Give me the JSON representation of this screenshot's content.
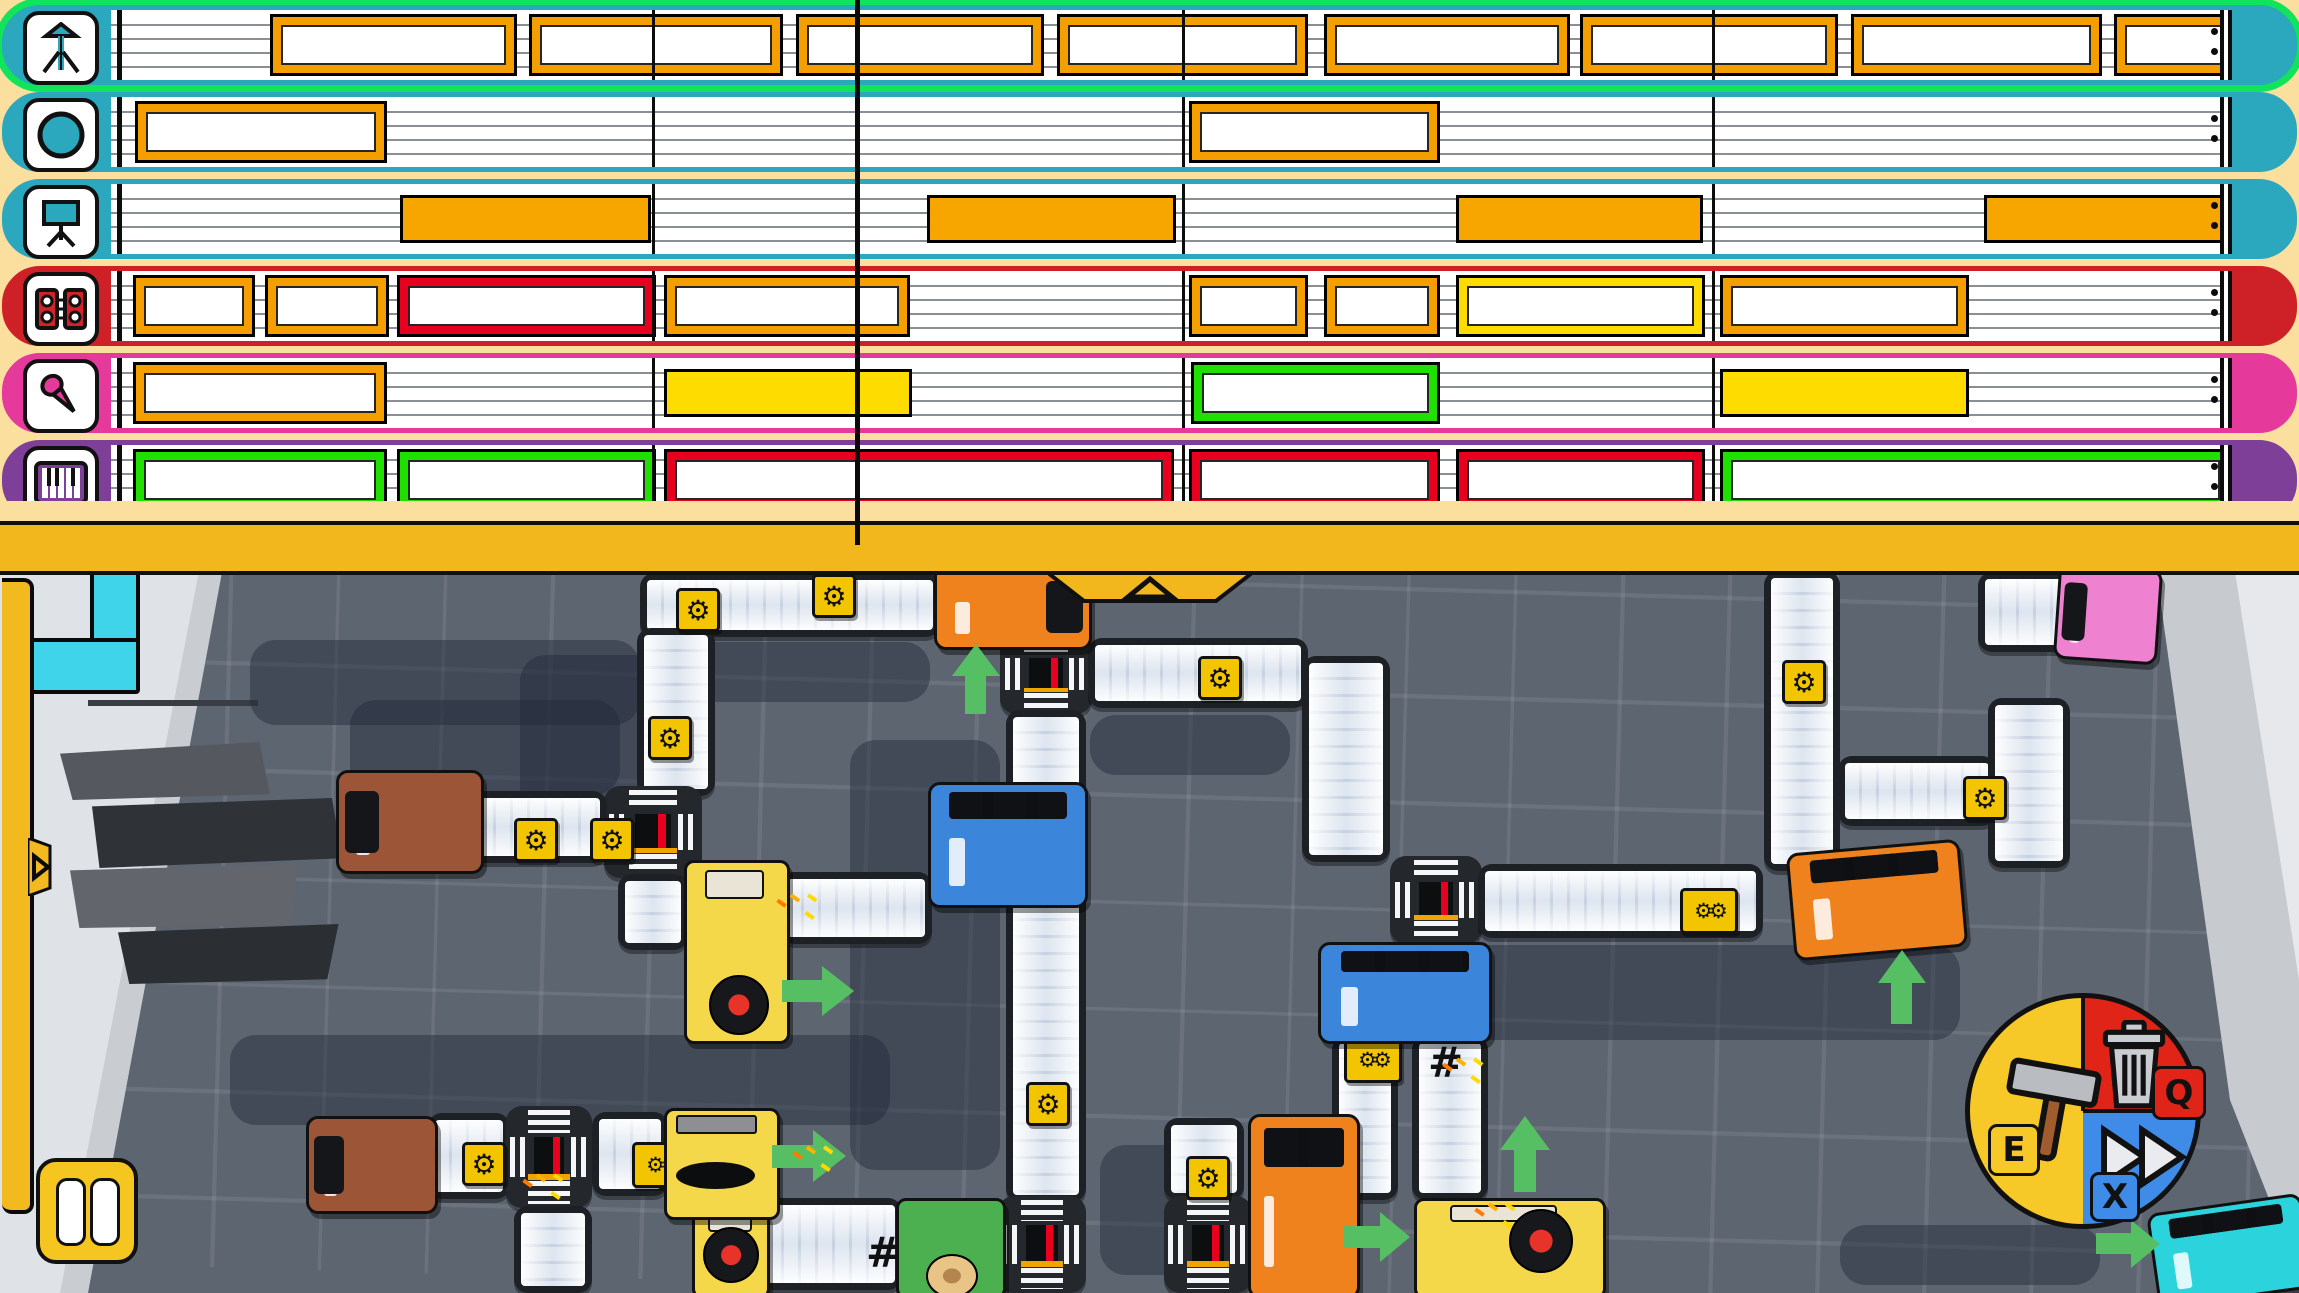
{
  "hud": {
    "keys": {
      "build": "E",
      "delete": "Q",
      "fast_forward": "X"
    },
    "pause_icon": "pause-icon",
    "pie_colors": {
      "build": "#f7c928",
      "delete": "#e02418",
      "fast_forward": "#3e8be8"
    }
  },
  "sequencer": {
    "playhead_x": 855,
    "measure_lines": [
      645,
      1175,
      1705
    ],
    "lane_start_x": 104,
    "block_colors": {
      "orange": "#f59e00",
      "orange_solid": "#f7a600",
      "red": "#e8001f",
      "yellow": "#ffdc00",
      "yellow_solid": "#ffdc00",
      "green": "#1fe000"
    },
    "tracks": [
      {
        "icon": "theremin",
        "color": "#2ba7be",
        "selected": true,
        "blocks": [
          [
            263,
            504,
            "orange"
          ],
          [
            522,
            770,
            "orange"
          ],
          [
            789,
            1031,
            "orange"
          ],
          [
            1050,
            1295,
            "orange"
          ],
          [
            1317,
            1557,
            "orange"
          ],
          [
            1573,
            1825,
            "orange"
          ],
          [
            1844,
            2089,
            "orange"
          ],
          [
            2107,
            2234,
            "orange"
          ]
        ]
      },
      {
        "icon": "pad",
        "color": "#2ba7be",
        "selected": false,
        "blocks": [
          [
            128,
            374,
            "orange"
          ],
          [
            1182,
            1427,
            "orange"
          ]
        ]
      },
      {
        "icon": "stand",
        "color": "#2ba7be",
        "selected": false,
        "blocks": [
          [
            393,
            638,
            "orange_solid"
          ],
          [
            920,
            1163,
            "orange_solid"
          ],
          [
            1449,
            1690,
            "orange_solid"
          ],
          [
            1977,
            2218,
            "orange_solid"
          ]
        ]
      },
      {
        "icon": "speakers",
        "color": "#ce2127",
        "selected": false,
        "blocks": [
          [
            126,
            242,
            "orange"
          ],
          [
            258,
            376,
            "orange"
          ],
          [
            390,
            643,
            "red"
          ],
          [
            657,
            897,
            "orange"
          ],
          [
            1182,
            1295,
            "orange"
          ],
          [
            1317,
            1427,
            "orange"
          ],
          [
            1449,
            1692,
            "yellow"
          ],
          [
            1713,
            1956,
            "orange"
          ]
        ]
      },
      {
        "icon": "mic",
        "color": "#e5399b",
        "selected": false,
        "blocks": [
          [
            126,
            374,
            "orange"
          ],
          [
            657,
            899,
            "yellow_solid"
          ],
          [
            1184,
            1427,
            "green"
          ],
          [
            1713,
            1956,
            "yellow_solid"
          ]
        ]
      },
      {
        "icon": "keys",
        "color": "#7d3f98",
        "selected": false,
        "blocks": [
          [
            126,
            374,
            "green"
          ],
          [
            390,
            643,
            "green"
          ],
          [
            657,
            1161,
            "red"
          ],
          [
            1182,
            1427,
            "red"
          ],
          [
            1449,
            1692,
            "red"
          ],
          [
            1713,
            2218,
            "green"
          ]
        ]
      }
    ]
  },
  "factory": {
    "items": [
      {
        "t": "shadow",
        "x": 250,
        "y": 640,
        "w": 390,
        "h": 85
      },
      {
        "t": "shadow",
        "x": 520,
        "y": 655,
        "w": 140,
        "h": 160
      },
      {
        "t": "shadow",
        "x": 640,
        "y": 642,
        "w": 290,
        "h": 60
      },
      {
        "t": "shadow",
        "x": 350,
        "y": 700,
        "w": 270,
        "h": 95
      },
      {
        "t": "shadow",
        "x": 850,
        "y": 740,
        "w": 150,
        "h": 430
      },
      {
        "t": "shadow",
        "x": 1090,
        "y": 715,
        "w": 200,
        "h": 60
      },
      {
        "t": "shadow",
        "x": 1460,
        "y": 945,
        "w": 500,
        "h": 95
      },
      {
        "t": "shadow",
        "x": 230,
        "y": 1035,
        "w": 660,
        "h": 90
      },
      {
        "t": "shadow",
        "x": 1100,
        "y": 1145,
        "w": 130,
        "h": 130
      },
      {
        "t": "shadow",
        "x": 1840,
        "y": 1225,
        "w": 260,
        "h": 60
      },
      {
        "t": "belt-h",
        "x": 640,
        "y": 573,
        "w": 300,
        "h": 64
      },
      {
        "t": "belt-v",
        "x": 637,
        "y": 628,
        "w": 78,
        "h": 168
      },
      {
        "t": "crossing",
        "x": 604,
        "y": 786,
        "w": 98,
        "h": 92
      },
      {
        "t": "belt-h",
        "x": 455,
        "y": 791,
        "w": 152,
        "h": 72
      },
      {
        "t": "belt-v",
        "x": 618,
        "y": 874,
        "w": 70,
        "h": 76
      },
      {
        "t": "belt-h",
        "x": 780,
        "y": 872,
        "w": 152,
        "h": 72
      },
      {
        "t": "crossing",
        "x": 1000,
        "y": 634,
        "w": 92,
        "h": 80
      },
      {
        "t": "belt-h",
        "x": 1088,
        "y": 638,
        "w": 220,
        "h": 70
      },
      {
        "t": "belt-v",
        "x": 1302,
        "y": 656,
        "w": 88,
        "h": 206
      },
      {
        "t": "crossing",
        "x": 1390,
        "y": 856,
        "w": 92,
        "h": 88
      },
      {
        "t": "belt-h",
        "x": 1478,
        "y": 864,
        "w": 285,
        "h": 74
      },
      {
        "t": "belt-h",
        "x": 1838,
        "y": 756,
        "w": 158,
        "h": 70
      },
      {
        "t": "belt-v",
        "x": 1764,
        "y": 571,
        "w": 76,
        "h": 300
      },
      {
        "t": "belt-v",
        "x": 1988,
        "y": 698,
        "w": 82,
        "h": 170
      },
      {
        "t": "belt-h",
        "x": 1978,
        "y": 572,
        "w": 94,
        "h": 80
      },
      {
        "t": "belt-v",
        "x": 1006,
        "y": 710,
        "w": 80,
        "h": 492
      },
      {
        "t": "crossing",
        "x": 998,
        "y": 1196,
        "w": 88,
        "h": 97
      },
      {
        "t": "belt-v",
        "x": 1332,
        "y": 1036,
        "w": 66,
        "h": 164
      },
      {
        "t": "belt-v",
        "x": 1412,
        "y": 1036,
        "w": 76,
        "h": 164
      },
      {
        "t": "belt-v",
        "x": 1164,
        "y": 1118,
        "w": 80,
        "h": 82
      },
      {
        "t": "crossing",
        "x": 1164,
        "y": 1196,
        "w": 88,
        "h": 97
      },
      {
        "t": "belt-h",
        "x": 428,
        "y": 1113,
        "w": 82,
        "h": 86
      },
      {
        "t": "crossing",
        "x": 506,
        "y": 1106,
        "w": 86,
        "h": 102
      },
      {
        "t": "belt-h",
        "x": 592,
        "y": 1112,
        "w": 76,
        "h": 84
      },
      {
        "t": "belt-v",
        "x": 514,
        "y": 1206,
        "w": 78,
        "h": 87
      },
      {
        "t": "belt-h",
        "x": 760,
        "y": 1198,
        "w": 142,
        "h": 92
      },
      {
        "t": "gear",
        "x": 676,
        "y": 588
      },
      {
        "t": "gear",
        "x": 812,
        "y": 574
      },
      {
        "t": "gear",
        "x": 648,
        "y": 716
      },
      {
        "t": "gear",
        "x": 514,
        "y": 818
      },
      {
        "t": "gear",
        "x": 590,
        "y": 818
      },
      {
        "t": "gear",
        "x": 1198,
        "y": 656
      },
      {
        "t": "gear",
        "x": 1026,
        "y": 1082
      },
      {
        "t": "gear",
        "x": 1186,
        "y": 1156
      },
      {
        "t": "gear",
        "x": 462,
        "y": 1142
      },
      {
        "t": "gear2",
        "x": 632,
        "y": 1142
      },
      {
        "t": "gear",
        "x": 1782,
        "y": 660
      },
      {
        "t": "gear",
        "x": 1963,
        "y": 776
      },
      {
        "t": "gear2",
        "x": 1680,
        "y": 888
      },
      {
        "t": "gear2",
        "x": 1344,
        "y": 1037
      },
      {
        "t": "hash",
        "x": 1428,
        "y": 1038
      },
      {
        "t": "hash",
        "x": 866,
        "y": 1228
      },
      {
        "t": "machine-turn",
        "x": 684,
        "y": 860,
        "w": 100,
        "h": 178,
        "dx": 22,
        "dy": 112,
        "ds": 56
      },
      {
        "t": "machine-turn",
        "x": 692,
        "y": 1210,
        "w": 72,
        "h": 83,
        "dx": 8,
        "dy": 14,
        "ds": 52
      },
      {
        "t": "machine-turn",
        "x": 1414,
        "y": 1198,
        "w": 186,
        "h": 95,
        "dx": 92,
        "dy": 8,
        "ds": 60
      },
      {
        "t": "machine-horn",
        "x": 664,
        "y": 1108,
        "w": 110,
        "h": 106
      },
      {
        "t": "machine-green",
        "x": 896,
        "y": 1198,
        "w": 104,
        "h": 95
      },
      {
        "t": "truck",
        "k": "brown",
        "x": 336,
        "y": 770,
        "w": 142,
        "h": 98,
        "cab": "left"
      },
      {
        "t": "truck",
        "k": "brown",
        "x": 306,
        "y": 1116,
        "w": 126,
        "h": 92,
        "cab": "left"
      },
      {
        "t": "truck",
        "k": "orange",
        "x": 934,
        "y": 564,
        "w": 152,
        "h": 80,
        "cab": "right"
      },
      {
        "t": "truck",
        "k": "orange",
        "x": 1790,
        "y": 846,
        "w": 168,
        "h": 102,
        "cab": "top",
        "rot": -5
      },
      {
        "t": "truck",
        "k": "orange",
        "x": 1248,
        "y": 1114,
        "w": 106,
        "h": 179,
        "cab": "top"
      },
      {
        "t": "truck",
        "k": "blue",
        "x": 928,
        "y": 782,
        "w": 154,
        "h": 120,
        "cab": "top"
      },
      {
        "t": "truck",
        "k": "blue",
        "x": 1318,
        "y": 942,
        "w": 168,
        "h": 96,
        "cab": "top"
      },
      {
        "t": "truck",
        "k": "pink",
        "x": 2056,
        "y": 566,
        "w": 98,
        "h": 90,
        "cab": "left",
        "rot": 4
      },
      {
        "t": "truck",
        "k": "cyan",
        "x": 2152,
        "y": 1203,
        "w": 150,
        "h": 90,
        "cab": "top",
        "rot": -8
      },
      {
        "t": "arrow-up",
        "x": 952,
        "y": 644,
        "w": 48,
        "h": 70
      },
      {
        "t": "arrow-up",
        "x": 1878,
        "y": 950,
        "w": 48,
        "h": 74
      },
      {
        "t": "arrow-up",
        "x": 1500,
        "y": 1116,
        "w": 50,
        "h": 76
      },
      {
        "t": "arrow-right",
        "x": 782,
        "y": 966,
        "w": 72,
        "h": 50
      },
      {
        "t": "arrow-right",
        "x": 772,
        "y": 1130,
        "w": 74,
        "h": 52
      },
      {
        "t": "arrow-right",
        "x": 1344,
        "y": 1212,
        "w": 66,
        "h": 50
      },
      {
        "t": "arrow-right",
        "x": 2096,
        "y": 1220,
        "w": 64,
        "h": 48
      },
      {
        "t": "spark",
        "x": 790,
        "y": 896
      },
      {
        "t": "spark",
        "x": 806,
        "y": 1148
      },
      {
        "t": "spark",
        "x": 1456,
        "y": 1060
      },
      {
        "t": "spark",
        "x": 1488,
        "y": 1205
      },
      {
        "t": "spark",
        "x": 536,
        "y": 1176
      }
    ],
    "truck_colors": {
      "brown": "#9c5637",
      "orange": "#ef821c",
      "blue": "#3b86db",
      "pink": "#ef82d0",
      "cyan": "#2bd4dc"
    }
  }
}
